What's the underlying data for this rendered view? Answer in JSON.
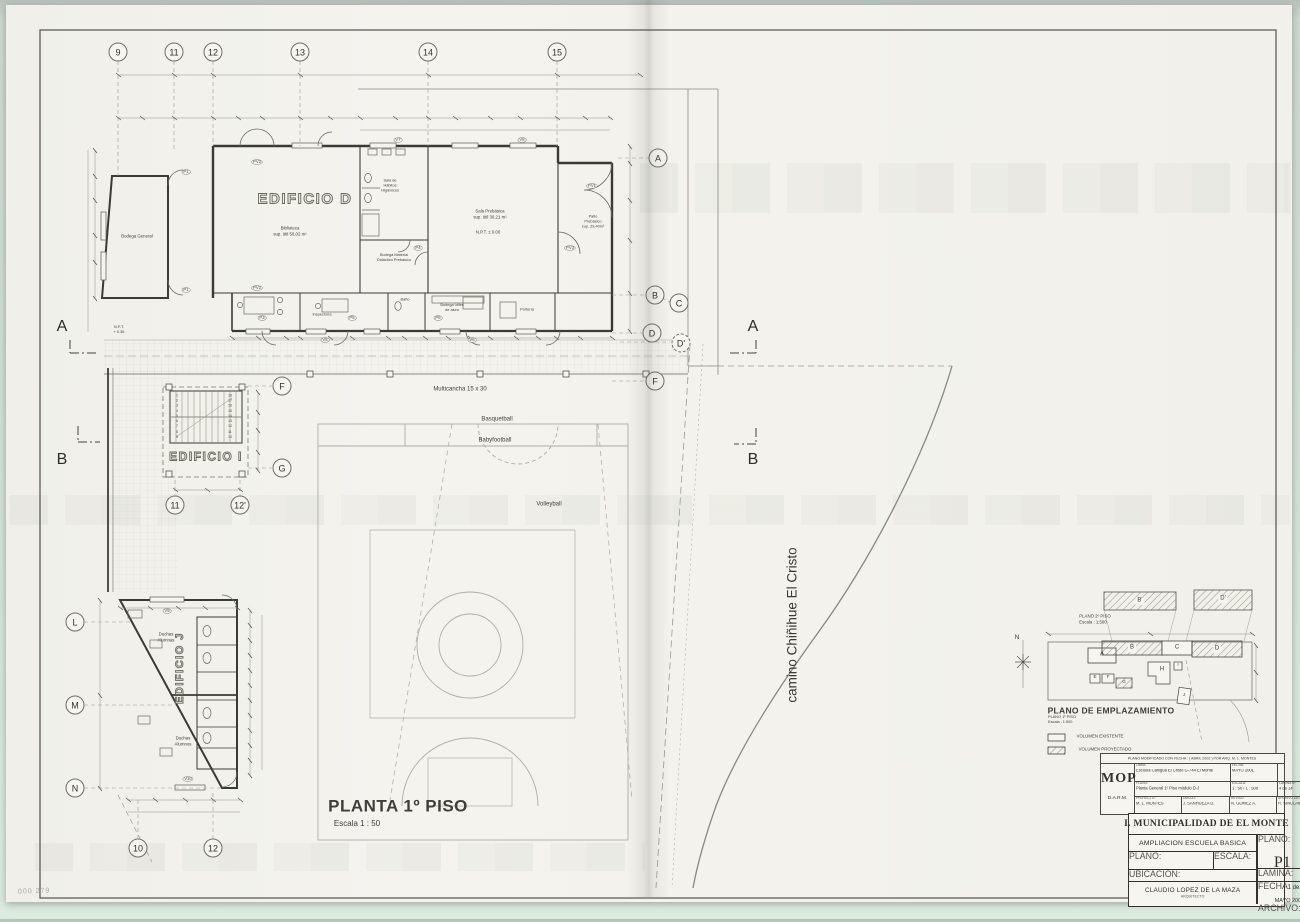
{
  "sheet": {
    "scan_mark": "000 279"
  },
  "plan": {
    "title": "PLANTA 1º PISO",
    "scale": "Escala 1 : 50",
    "road": "camino Chiñihue El Cristo",
    "multicancha": "Multicancha 15 x 30",
    "court": {
      "basquetball": "Basquetball",
      "babyfootball": "Babyfootball",
      "volleyball": "Volleyball"
    },
    "npt_entrance": "N.P.T.\n+ 0.36"
  },
  "buildings": {
    "d": "EDIFICIO D",
    "i": "EDIFICIO I",
    "j": "EDIFICIO J"
  },
  "rooms": {
    "bodega_general": "Bodega General",
    "biblioteca": "Biblioteca\nsup. útil 50,02 m²",
    "habitos": "Sala de\nHábitos\nHigiénicos",
    "sala_prebasica": "Sala Prebásica\nsup. útil 30,21 m²",
    "sala_prebasica_npt": "N.P.T. ± 0.00",
    "bodega_material": "Bodega Material\nDidáctico Prebásico",
    "patio_prebasico": "Patio\nPrebásico\nsup. 29,40m²",
    "inspectoria": "Inspectoría",
    "bano": "Baño",
    "bodega_utiles": "Bodega útiles\nde aseo",
    "porteria": "Portería",
    "duchas_alumnas": "Duchas\nAlumnas",
    "duchas_alumnos": "Duchas\nAlumnos"
  },
  "grid": {
    "c9": "9",
    "c11": "11",
    "c12": "12",
    "c13": "13",
    "c14": "14",
    "c15": "15",
    "rA": "A",
    "rB": "B",
    "rC": "C",
    "rD": "D",
    "rDp": "D'",
    "rF": "F",
    "sF": "F",
    "sG": "G",
    "s11": "11",
    "s12p": "12'",
    "jL": "L",
    "jM": "M",
    "jN": "N",
    "j10": "10",
    "j12": "12",
    "secA": "A",
    "secB": "B"
  },
  "tags": {
    "p1a": "P1",
    "p1b": "P1",
    "pv2a": "PV2",
    "pv2b": "PV2",
    "pv1": "PV1",
    "pv3": "PV3",
    "p3": "P3",
    "p4": "P4",
    "p5": "P5",
    "p6": "P6",
    "v5": "V5",
    "v6": "V6",
    "v7": "V7",
    "v8": "V8",
    "v9": "V9",
    "v10": "V10"
  },
  "stair": {
    "left": [
      "1",
      "2",
      "3",
      "4",
      "5",
      "6",
      "7",
      "8",
      "9"
    ],
    "right": [
      "18",
      "17",
      "16",
      "15",
      "14",
      "13",
      "12",
      "11",
      "10"
    ]
  },
  "site": {
    "title": "PLANO DE EMPLAZAMIENTO",
    "sub1": "PLANO 1º PISO",
    "sub2": "Escala : 1:500",
    "upper1": "PLANO 2º PISO",
    "upper2": "Escala : 1:500",
    "legend_existing": "VOLUMEN EXISTENTE",
    "legend_projected": "VOLUMEN PROYECTADO",
    "north": "N",
    "bA": "A",
    "bB": "B",
    "bC": "C",
    "bD": "D",
    "bBp": "B'",
    "bDp": "D'",
    "bE": "E",
    "bF": "F",
    "bG": "G",
    "bH": "H",
    "bI": "I",
    "bJ": "J"
  },
  "mop": {
    "header": "PLANO MODIFICADO CON FECHA :   ( ABRIL 2002 )  POR ARQ. M. L. MONTES",
    "logo": "MOP",
    "dept": "D.A.R.M.",
    "obra_label": "OBRA:",
    "obra": "Escuela Cañigua El Cristo G-744 El Monte",
    "fecha_label": "FECHA:",
    "fecha": "MAYO 2001",
    "plano_label": "PLANO:",
    "plano": "Planta General 1º Piso módulo D-J",
    "escala_label": "ESCALA:",
    "escala": "1 : 50 / 1 : 500",
    "lamina_label": "LAMINA Nº",
    "lamina": "4 de 14",
    "proyecto_label": "PROYECTO:",
    "proyecto": "M. L. MONTES",
    "dibujo_label": "DIBUJO:",
    "dibujo": "J. SANHUEZA D.",
    "reviso_label": "REVISO:",
    "reviso": "N. GOMEZ A.",
    "archivo_label": "ARCHIVO DIGITAL:",
    "archivo": "R. SINCLAIR R."
  },
  "tb": {
    "municipality": "I. MUNICIPALIDAD DE EL MONTE",
    "project": "AMPLIACION ESCUELA BASICA",
    "plano_label": "PLANO:",
    "plano": "PLANTA GENERAL",
    "escala_label": "ESCALA:",
    "escala": "1 : 50",
    "sheet_label": "PLANO:",
    "sheet": "P1",
    "lamina_label": "LAMINA:",
    "lamina": "1 de 6",
    "ubicacion_label": "UBICACION:",
    "fecha_label": "FECHA:",
    "fecha": "MAYO 2001",
    "archivo_label": "ARCHIVO:",
    "architect": "CLAUDIO LOPEZ DE LA MAZA",
    "architect_title": "ARQUITECTO"
  }
}
